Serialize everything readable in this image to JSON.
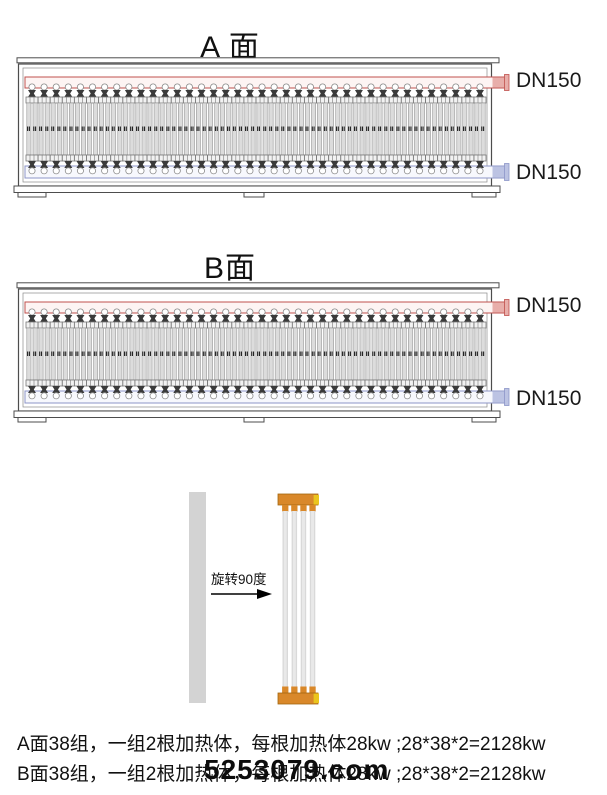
{
  "titles": {
    "panel_a": "A 面",
    "panel_b": "B面"
  },
  "labels": {
    "dn150": "DN150",
    "rotate": "旋转90度"
  },
  "notes": {
    "line_a": "A面38组，一组2根加热体，每根加热体28kw ;28*38*2=2128kw",
    "line_b": "B面38组，一组2根加热体，每根加热体28kw ;28*38*2=2128kw"
  },
  "watermark": "5253079.com",
  "diagram": {
    "group_count": 38,
    "tubes_per_group": 2,
    "detail_tube_count": 4,
    "colors": {
      "frame": "#4d4d4d",
      "frame_inner": "#8a8a8a",
      "pipe_top_stroke": "#c0504d",
      "pipe_top_light": "#fdf4f3",
      "pipe_top_fill": "#e8aeaa",
      "pipe_bottom_stroke": "#8d96c8",
      "pipe_bottom_light": "#f7f8fd",
      "pipe_bottom_fill": "#bcc3e3",
      "tube_fill": "#dcdcdc",
      "tube_stroke": "#9a9a9a",
      "bracket_fill": "#f2f2f2",
      "bracket_stroke": "#777777",
      "connector": "#3a3a3a",
      "dot": "#222222",
      "cap_orange": "#d9882a",
      "cap_orange_dark": "#a2660f",
      "cap_yellow": "#eac51e",
      "detail_tube": "#d9d9d9",
      "bar_grey": "#d3d3d3"
    }
  }
}
